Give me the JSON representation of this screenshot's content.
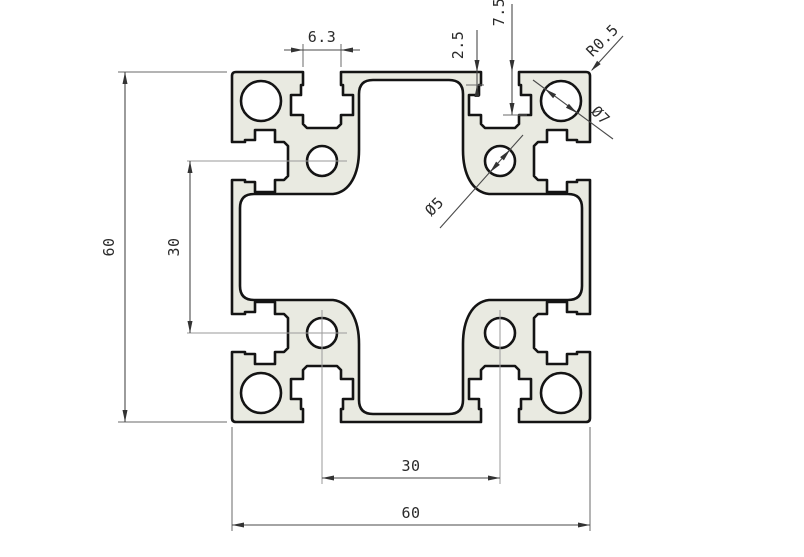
{
  "drawing": {
    "type": "extrusion-profile-cross-section",
    "dims": {
      "slot_opening": "6.3",
      "lip_depth": "2.5",
      "slot_depth": "7.5",
      "corner_radius": "R0.5",
      "corner_hole_dia": "Ø7",
      "center_hole_dia": "Ø5",
      "overall_height": "60",
      "hole_spacing_vertical": "30",
      "hole_spacing_horizontal": "30",
      "overall_width": "60"
    },
    "colors": {
      "profile_fill": "#e9eae1",
      "outline": "#141414",
      "dimension_lines": "#4a4a4a",
      "centerlines": "#9a9a9a",
      "background": "#ffffff"
    }
  }
}
